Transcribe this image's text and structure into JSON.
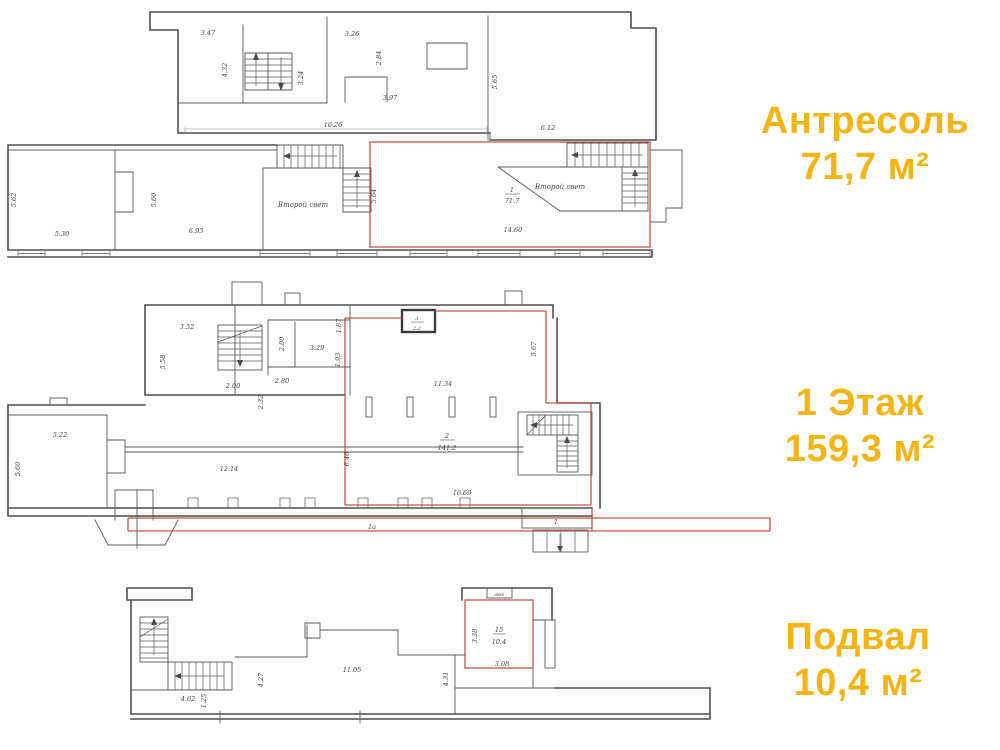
{
  "colors": {
    "accent": "#f4b414",
    "wall": "#4f4f4f",
    "highlight_red": "#c0564a"
  },
  "floors": [
    {
      "key": "mezzanine",
      "title": "Антресоль",
      "area": "71,7 м²"
    },
    {
      "key": "floor1",
      "title": "1 Этаж",
      "area": "159,3 м²"
    },
    {
      "key": "basement",
      "title": "Подвал",
      "area": "10,4 м²"
    }
  ],
  "mezz": {
    "d347": "3.47",
    "d432": "4.32",
    "d324": "3.24",
    "d326": "3.26",
    "d284": "2.84",
    "d397": "3.97",
    "d1626": "16.26",
    "d565": "5.65",
    "d612": "6.12",
    "d562": "5.62",
    "d530": "5.30",
    "d560": "5.60",
    "d693": "6.93",
    "d564": "5.64",
    "d1460": "14.60",
    "room_no": "1",
    "room_area": "71.7",
    "second_light_a": "Второй свет",
    "second_light_b": "Второй свет"
  },
  "f1": {
    "d352": "3.52",
    "d558": "5.58",
    "d200": "2.00",
    "d280v": "2.80",
    "d187": "1.87",
    "d329": "3.29",
    "d193": "1.93",
    "d280h": "2.80",
    "d232": "2.32",
    "d1134": "11.34",
    "d567": "5.67",
    "d646": "6.46",
    "d522": "5.22",
    "d560": "5.60",
    "d1214": "12.14",
    "d1669": "16.69",
    "wc_no": "3",
    "wc_area": "2.2",
    "hall_no": "2",
    "hall_area": "141.2",
    "strip": "1а",
    "vestibule": "1"
  },
  "bsm": {
    "d462": "4.62",
    "d125": "1.25",
    "d427": "4.27",
    "d1105": "11.05",
    "d431": "4.31",
    "d338": "3.38",
    "d308": "3.08",
    "room_no": "15",
    "room_area": "10.4",
    "hatch": "люк"
  }
}
